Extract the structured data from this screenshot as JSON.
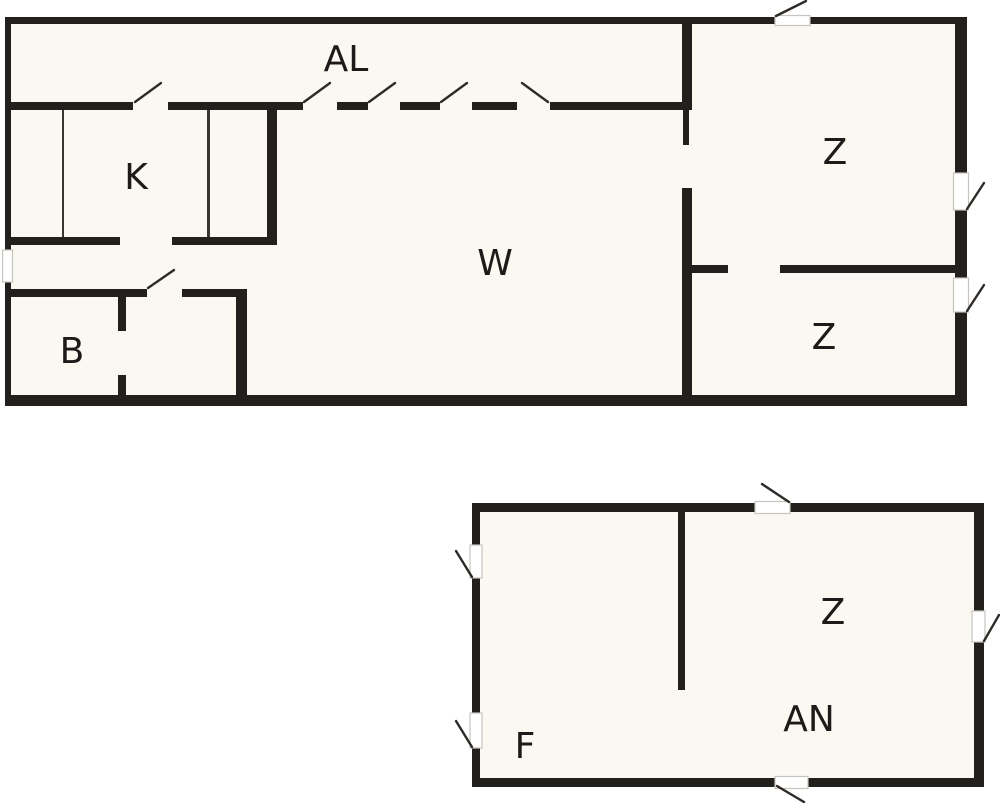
{
  "diagram": {
    "type": "floor-plan",
    "buildings": [
      "main-house",
      "annex"
    ]
  },
  "colors": {
    "background": "#ffffff",
    "room_fill": "#faf9f1",
    "wall": "#231f1d",
    "thin_wall": "#3a3533",
    "swing": "#2e2b29",
    "label": "#1d1b19"
  },
  "rooms": {
    "al": {
      "label": "AL"
    },
    "k": {
      "label": "K"
    },
    "w": {
      "label": "W"
    },
    "z_main_upper": {
      "label": "Z"
    },
    "z_main_lower": {
      "label": "Z"
    },
    "b": {
      "label": "B"
    },
    "z_annex": {
      "label": "Z"
    },
    "an": {
      "label": "AN"
    },
    "f": {
      "label": "F"
    }
  }
}
